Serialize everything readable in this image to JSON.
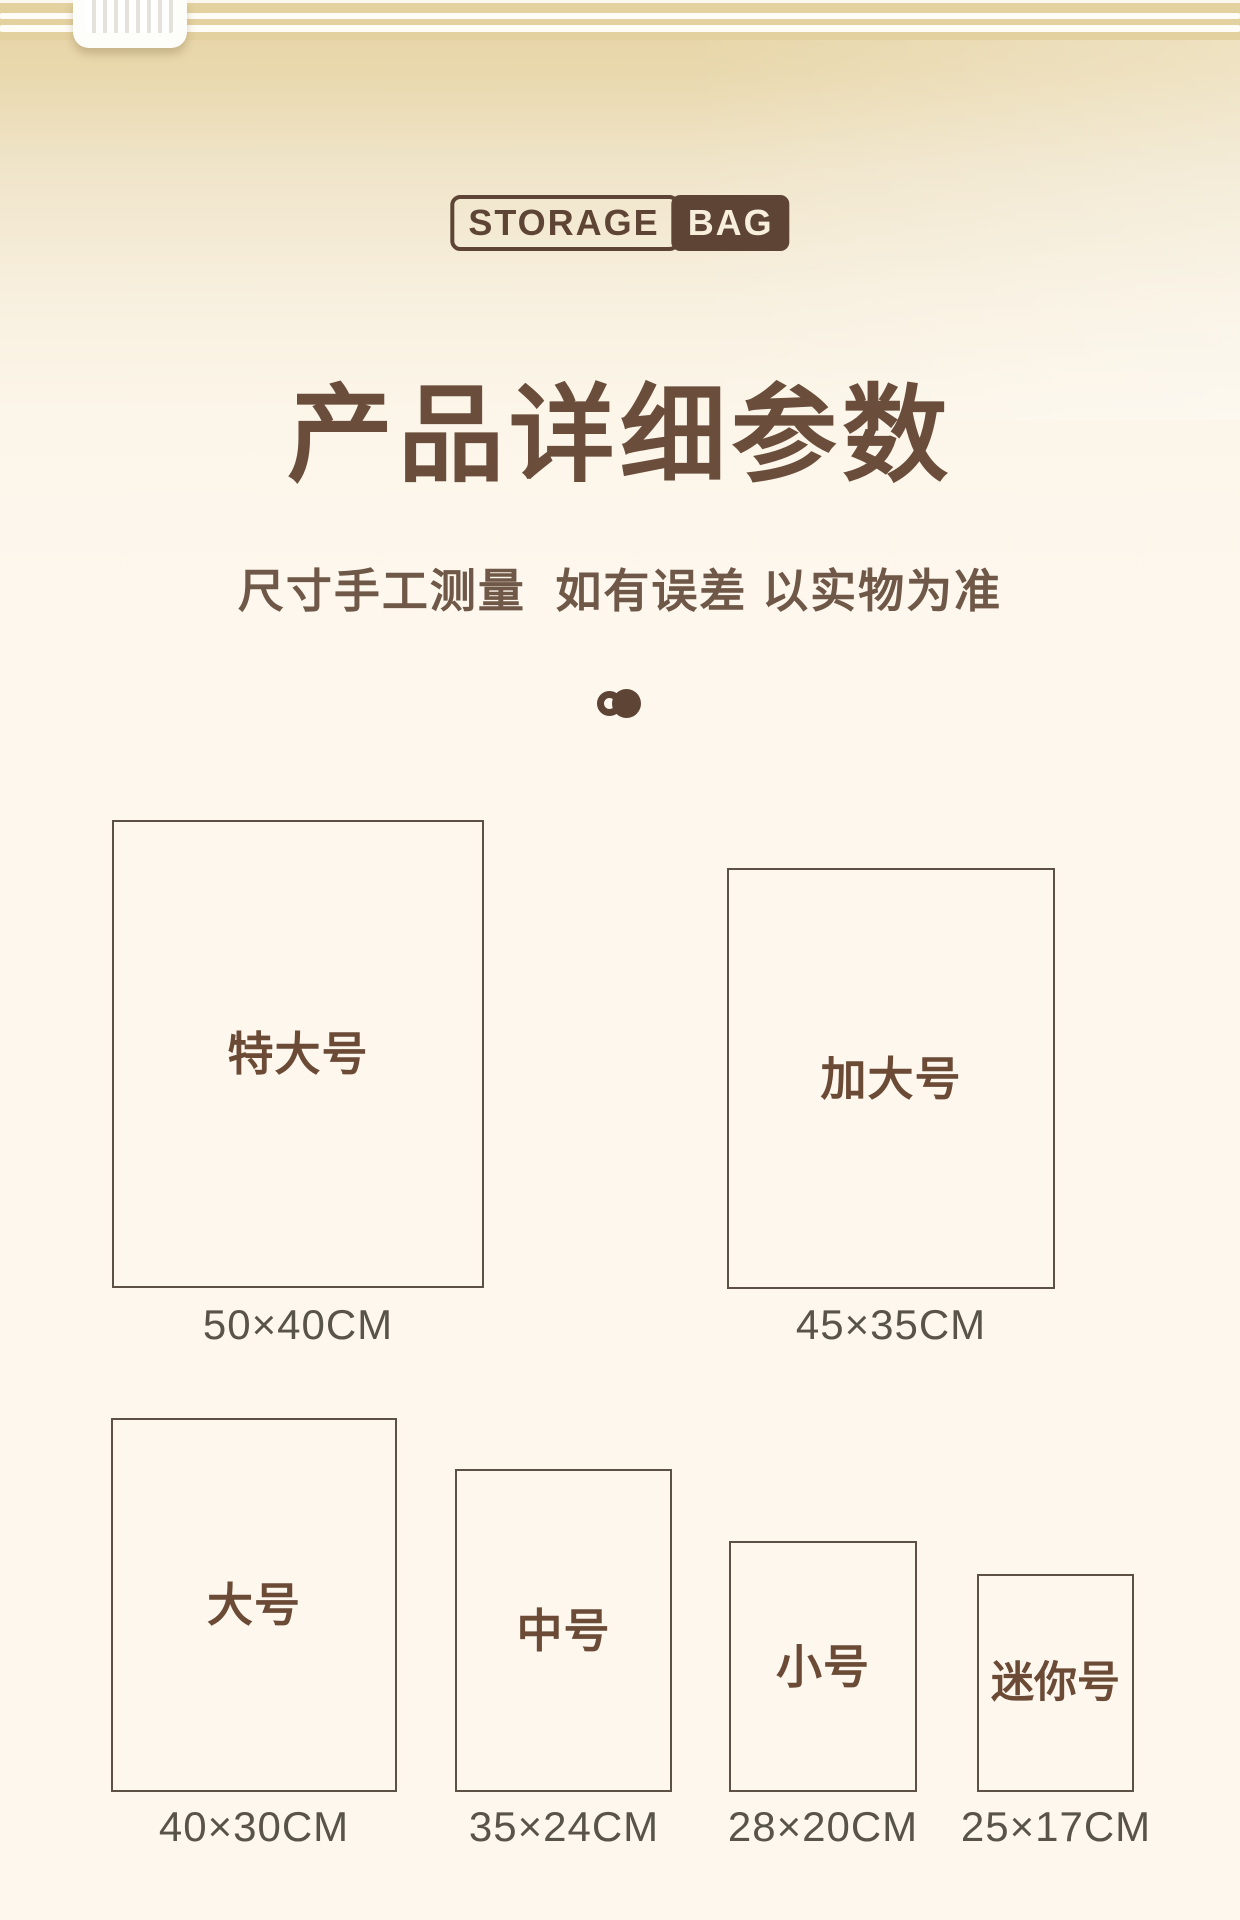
{
  "brand_logo": {
    "storage": "STORAGE",
    "bag": "BAG"
  },
  "heading": {
    "title": "产品详细参数",
    "subtitle": "尺寸手工测量  如有误差 以实物为准"
  },
  "carousel": {
    "dot_count": 2,
    "active_dot": 2
  },
  "bag_top": {
    "zipper_slider_icon": "zipper-slider-icon",
    "seal_line_count": 2
  },
  "sizes": [
    {
      "name": "特大号",
      "dimensions": "50×40CM"
    },
    {
      "name": "加大号",
      "dimensions": "45×35CM"
    },
    {
      "name": "大号",
      "dimensions": "40×30CM"
    },
    {
      "name": "中号",
      "dimensions": "35×24CM"
    },
    {
      "name": "小号",
      "dimensions": "28×20CM"
    },
    {
      "name": "迷你号",
      "dimensions": "25×17CM"
    }
  ],
  "colors": {
    "brand_brown": "#5d4435",
    "title_brown": "#6a4e3b",
    "label_brown": "#6b4a36",
    "box_border_brown": "#5d5044",
    "dimension_text": "#59544a",
    "top_band_tan": "#e4d1a0",
    "background_cream": "#fdf7ee",
    "logo_bag_text_cream": "#f7eedb"
  }
}
